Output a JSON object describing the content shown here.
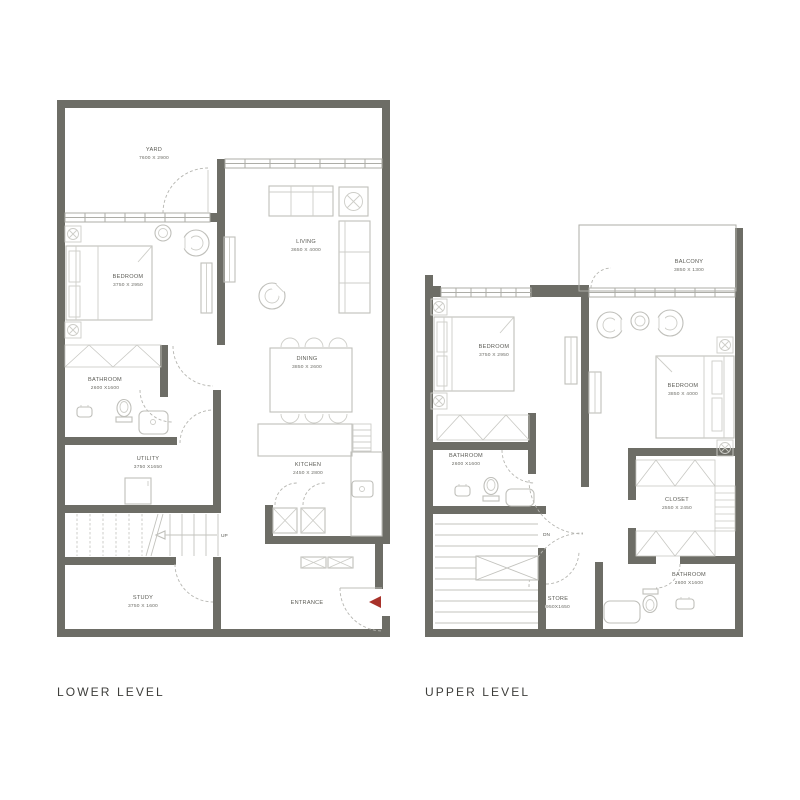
{
  "captions": {
    "lower": "LOWER LEVEL",
    "upper": "UPPER LEVEL"
  },
  "colors": {
    "wall": "#6d6d66",
    "furniture_line": "#bfbfba",
    "door_dash": "#b6b6b1",
    "label_text": "#5c5c56",
    "caption_text": "#3e3e3b",
    "entrance_arrow_red": "#a8322a",
    "background": "#ffffff"
  },
  "lower_level": {
    "rooms": {
      "yard": {
        "name": "YARD",
        "dims": "7600 X 2900"
      },
      "bedroom": {
        "name": "BEDROOM",
        "dims": "3750 X 2950"
      },
      "living": {
        "name": "LIVING",
        "dims": "3650 X 4000"
      },
      "dining": {
        "name": "DINING",
        "dims": "3850 X 2600"
      },
      "bathroom": {
        "name": "BATHROOM",
        "dims": "2600 X1600"
      },
      "utility": {
        "name": "UTILITY",
        "dims": "3750 X1650"
      },
      "kitchen": {
        "name": "KITCHEN",
        "dims": "2450 X 2800"
      },
      "study": {
        "name": "STUDY",
        "dims": "3750 X 1600"
      },
      "entrance": {
        "name": "ENTRANCE"
      },
      "stairs": {
        "label": "UP"
      }
    }
  },
  "upper_level": {
    "rooms": {
      "balcony": {
        "name": "BALCONY",
        "dims": "3850 X 1300"
      },
      "bedroom_left": {
        "name": "BEDROOM",
        "dims": "3750 X 2950"
      },
      "bedroom_right": {
        "name": "BEDROOM",
        "dims": "3850 X 4000"
      },
      "bathroom_left": {
        "name": "BATHROOM",
        "dims": "2600 X1600"
      },
      "closet": {
        "name": "CLOSET",
        "dims": "2550 X 2450"
      },
      "bathroom_right": {
        "name": "BATHROOM",
        "dims": "2600 X1600"
      },
      "store": {
        "name": "STORE",
        "dims": "950X1650"
      },
      "stairs": {
        "label": "DN"
      }
    }
  }
}
